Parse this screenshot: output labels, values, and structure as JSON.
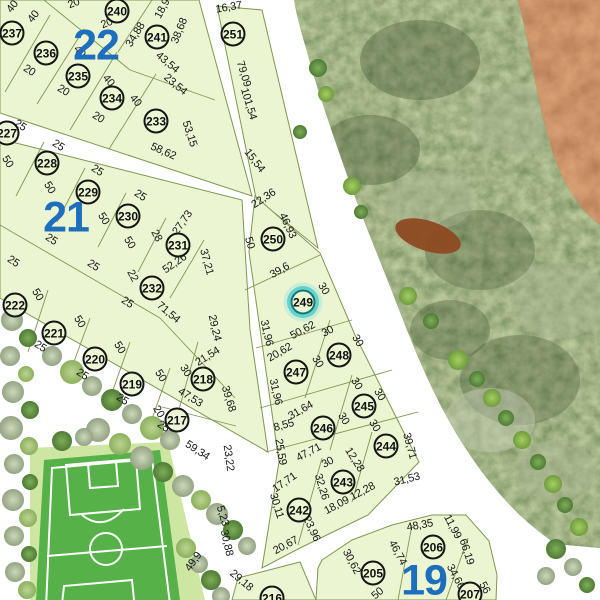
{
  "map": {
    "selected_lot": "249",
    "colors": {
      "parcel_fill": "#ecf5d2",
      "parcel_stroke": "#7f9750",
      "block_number_blue": "#1d6fbe",
      "highlight_teal": "#2fb9b9",
      "field_green": "#56b148",
      "forest_base": "#68794b",
      "dirt_brown": "#99521f"
    },
    "blocks": [
      {
        "label": "22",
        "x": 96,
        "y": 46
      },
      {
        "label": "21",
        "x": 66,
        "y": 218
      },
      {
        "label": "19",
        "x": 424,
        "y": 581
      }
    ],
    "lots": [
      [
        "237",
        12,
        33
      ],
      [
        "236",
        46,
        53
      ],
      [
        "235",
        78,
        76
      ],
      [
        "234",
        112,
        98
      ],
      [
        "240",
        117,
        11
      ],
      [
        "241",
        157,
        37
      ],
      [
        "233",
        156,
        121
      ],
      [
        "251",
        233,
        34
      ],
      [
        "227",
        7,
        133
      ],
      [
        "228",
        47,
        163
      ],
      [
        "229",
        88,
        192
      ],
      [
        "230",
        128,
        216
      ],
      [
        "231",
        178,
        245
      ],
      [
        "232",
        152,
        288
      ],
      [
        "222",
        15,
        305
      ],
      [
        "221",
        54,
        333
      ],
      [
        "220",
        95,
        359
      ],
      [
        "219",
        132,
        384
      ],
      [
        "218",
        203,
        379
      ],
      [
        "217",
        177,
        420
      ],
      [
        "250",
        273,
        239
      ],
      [
        "249",
        303,
        302
      ],
      [
        "248",
        339,
        355
      ],
      [
        "247",
        296,
        372
      ],
      [
        "245",
        364,
        406
      ],
      [
        "246",
        323,
        428
      ],
      [
        "244",
        386,
        446
      ],
      [
        "243",
        343,
        482
      ],
      [
        "242",
        299,
        510
      ],
      [
        "205",
        373,
        573
      ],
      [
        "206",
        433,
        547
      ],
      [
        "216",
        272,
        598
      ],
      [
        "207",
        470,
        594
      ]
    ],
    "dims": [
      [
        "40",
        13,
        7,
        -52
      ],
      [
        "40",
        34,
        17,
        -52
      ],
      [
        "20",
        74,
        4,
        -22
      ],
      [
        "20",
        107,
        24,
        -22
      ],
      [
        "34,88",
        136,
        35,
        -58
      ],
      [
        "18,9",
        163,
        9,
        -62
      ],
      [
        "38,68",
        180,
        31,
        -68
      ],
      [
        "43,54",
        167,
        63,
        40
      ],
      [
        "23,54",
        175,
        85,
        40
      ],
      [
        "20",
        29,
        71,
        32
      ],
      [
        "20",
        63,
        91,
        32
      ],
      [
        "20",
        98,
        118,
        32
      ],
      [
        "40",
        79,
        52,
        50
      ],
      [
        "40",
        108,
        81,
        50
      ],
      [
        "40",
        135,
        101,
        50
      ],
      [
        "53,15",
        189,
        134,
        72
      ],
      [
        "58,62",
        163,
        152,
        24
      ],
      [
        "16,37",
        229,
        8,
        -10
      ],
      [
        "79,09",
        243,
        74,
        73
      ],
      [
        "101,54",
        248,
        104,
        73
      ],
      [
        "15,54",
        254,
        161,
        52
      ],
      [
        "25",
        20,
        126,
        33
      ],
      [
        "25",
        58,
        146,
        33
      ],
      [
        "25",
        97,
        171,
        33
      ],
      [
        "25",
        140,
        196,
        33
      ],
      [
        "28",
        156,
        236,
        62
      ],
      [
        "27,73",
        183,
        223,
        -55
      ],
      [
        "37,21",
        206,
        262,
        75
      ],
      [
        "52,26",
        175,
        264,
        -35
      ],
      [
        "50",
        7,
        162,
        58
      ],
      [
        "50",
        49,
        188,
        58
      ],
      [
        "50",
        103,
        219,
        58
      ],
      [
        "50",
        129,
        243,
        58
      ],
      [
        "25",
        13,
        262,
        33
      ],
      [
        "25",
        51,
        240,
        33
      ],
      [
        "25",
        93,
        266,
        33
      ],
      [
        "22",
        132,
        276,
        62
      ],
      [
        "25",
        127,
        303,
        33
      ],
      [
        "71,54",
        168,
        313,
        40
      ],
      [
        "50",
        37,
        295,
        58
      ],
      [
        "25",
        40,
        347,
        33
      ],
      [
        "50",
        79,
        322,
        58
      ],
      [
        "25",
        82,
        375,
        33
      ],
      [
        "50",
        119,
        348,
        58
      ],
      [
        "25",
        122,
        400,
        33
      ],
      [
        "50",
        160,
        376,
        58
      ],
      [
        "25",
        163,
        427,
        33
      ],
      [
        "30",
        185,
        371,
        58
      ],
      [
        "21,54",
        208,
        357,
        -32
      ],
      [
        "39,68",
        228,
        399,
        73
      ],
      [
        "47,53",
        190,
        398,
        32
      ],
      [
        "20",
        158,
        412,
        58
      ],
      [
        "59,34",
        197,
        451,
        33
      ],
      [
        "29,24",
        214,
        328,
        77
      ],
      [
        "23,22",
        228,
        458,
        82
      ],
      [
        "22,36",
        264,
        199,
        -33
      ],
      [
        "46,93",
        287,
        226,
        65
      ],
      [
        "50",
        249,
        243,
        73
      ],
      [
        "39,6",
        280,
        271,
        -30
      ],
      [
        "30",
        323,
        289,
        58
      ],
      [
        "31,96",
        266,
        333,
        77
      ],
      [
        "50,62",
        303,
        331,
        -28
      ],
      [
        "30",
        328,
        332,
        -28
      ],
      [
        "30",
        357,
        341,
        58
      ],
      [
        "20,62",
        280,
        353,
        -30
      ],
      [
        "30",
        317,
        362,
        58
      ],
      [
        "31,96",
        275,
        392,
        77
      ],
      [
        "30",
        356,
        384,
        58
      ],
      [
        "30",
        379,
        395,
        58
      ],
      [
        "31,64",
        301,
        411,
        -30
      ],
      [
        "30",
        343,
        419,
        58
      ],
      [
        "30",
        374,
        426,
        58
      ],
      [
        "8,55",
        284,
        426,
        -15
      ],
      [
        "47,71",
        309,
        453,
        -28
      ],
      [
        "25,59",
        280,
        452,
        80
      ],
      [
        "30",
        328,
        463,
        -28
      ],
      [
        "12,28",
        354,
        460,
        58
      ],
      [
        "39,71",
        409,
        446,
        75
      ],
      [
        "31,53",
        407,
        480,
        -14
      ],
      [
        "32,26",
        321,
        487,
        73
      ],
      [
        "12,28",
        363,
        492,
        -28
      ],
      [
        "18,09",
        337,
        506,
        -28
      ],
      [
        "17,71",
        285,
        483,
        -35
      ],
      [
        "30,11",
        276,
        506,
        73
      ],
      [
        "23,96",
        311,
        529,
        65
      ],
      [
        "20,67",
        286,
        546,
        -28
      ],
      [
        "29,18",
        241,
        581,
        40
      ],
      [
        "49,9",
        194,
        562,
        -55
      ],
      [
        "30,88",
        226,
        543,
        77
      ],
      [
        "5,23",
        222,
        516,
        73
      ],
      [
        "48,35",
        420,
        526,
        -10
      ],
      [
        "46,74",
        397,
        553,
        62
      ],
      [
        "11,99",
        452,
        527,
        62
      ],
      [
        "66,19",
        466,
        552,
        72
      ],
      [
        "34,66",
        455,
        577,
        62
      ],
      [
        "30,62",
        351,
        562,
        62
      ],
      [
        "50",
        378,
        594,
        -40
      ],
      [
        "56",
        484,
        588,
        62
      ]
    ]
  }
}
